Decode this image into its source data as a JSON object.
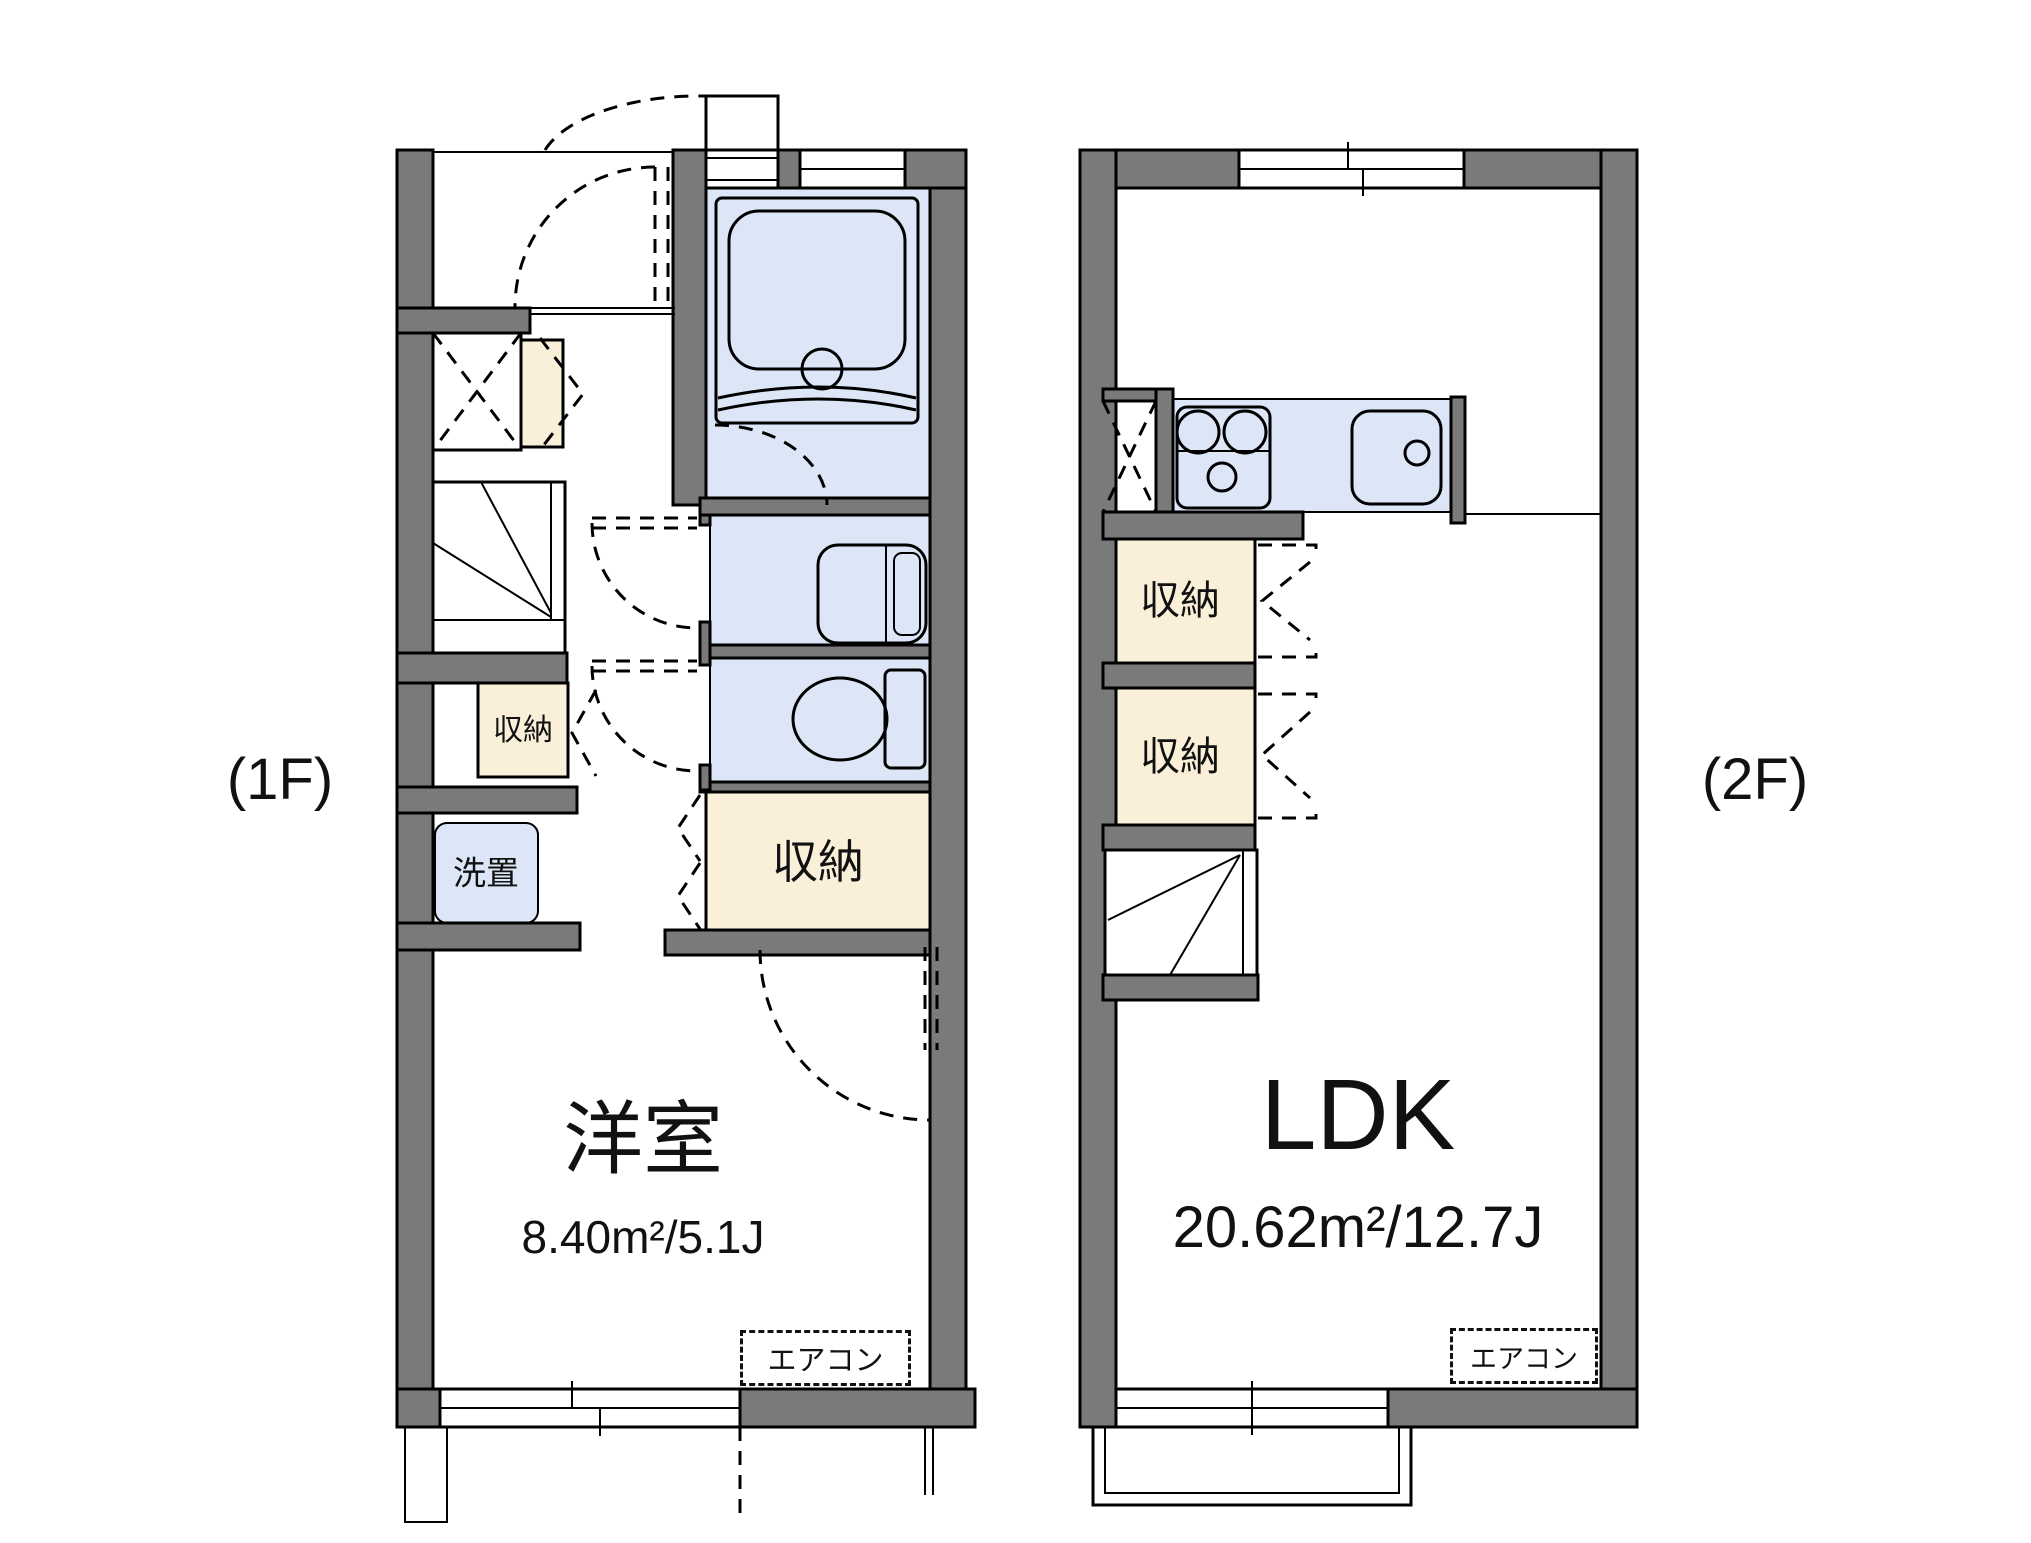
{
  "floor1": {
    "label": "(1F)",
    "room_name": "洋室",
    "room_area": "8.40m²/5.1J",
    "storage_small_label": "収納",
    "storage_label": "収納",
    "laundry_label": "洗置",
    "aircon_label": "エアコン"
  },
  "floor2": {
    "label": "(2F)",
    "room_name": "LDK",
    "room_area": "20.62m²/12.7J",
    "storage1_label": "収納",
    "storage2_label": "収納",
    "aircon_label": "エアコン"
  },
  "colors": {
    "wall": "#7a7a7a",
    "wet": "#dce6f6",
    "storage": "#faf0da",
    "line": "#000000",
    "bg": "#ffffff"
  }
}
